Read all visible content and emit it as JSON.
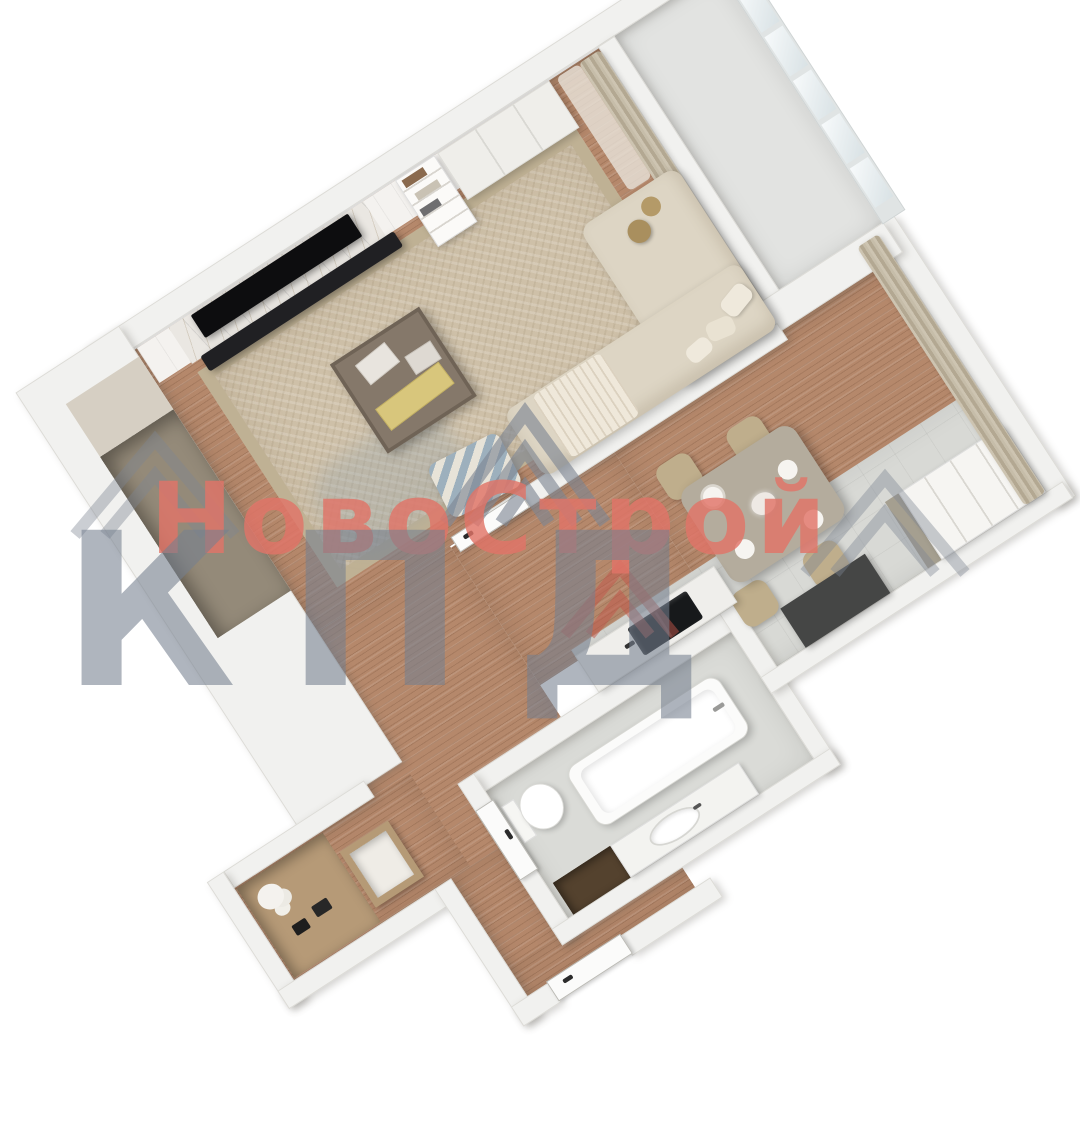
{
  "watermark": {
    "brand": "НовоСтрой",
    "abbr": "КПД"
  },
  "palette": {
    "wall": "#f1f1ef",
    "wood_floor": "#b5886b",
    "tile_floor": "#d8d9d5",
    "balcony_floor": "#e2e3e1",
    "rug": "#cec0a8",
    "rug_border": "#bfb194",
    "accent_red": "#e0746a",
    "watermark_gray": "#757f8f",
    "curtain": "#c2b8a4",
    "sofa": "#ddd5c4",
    "table_top": "#b4ac9d",
    "chair": "#bfae8c",
    "counter_dark": "#454645",
    "sink_black": "#17191b",
    "tv_black": "#0d0d0f",
    "vanity_dark": "#54422e",
    "niche_taupe": "#948a79",
    "ledge_beige": "#d6cfc3",
    "console_wood": "#b69a77"
  }
}
